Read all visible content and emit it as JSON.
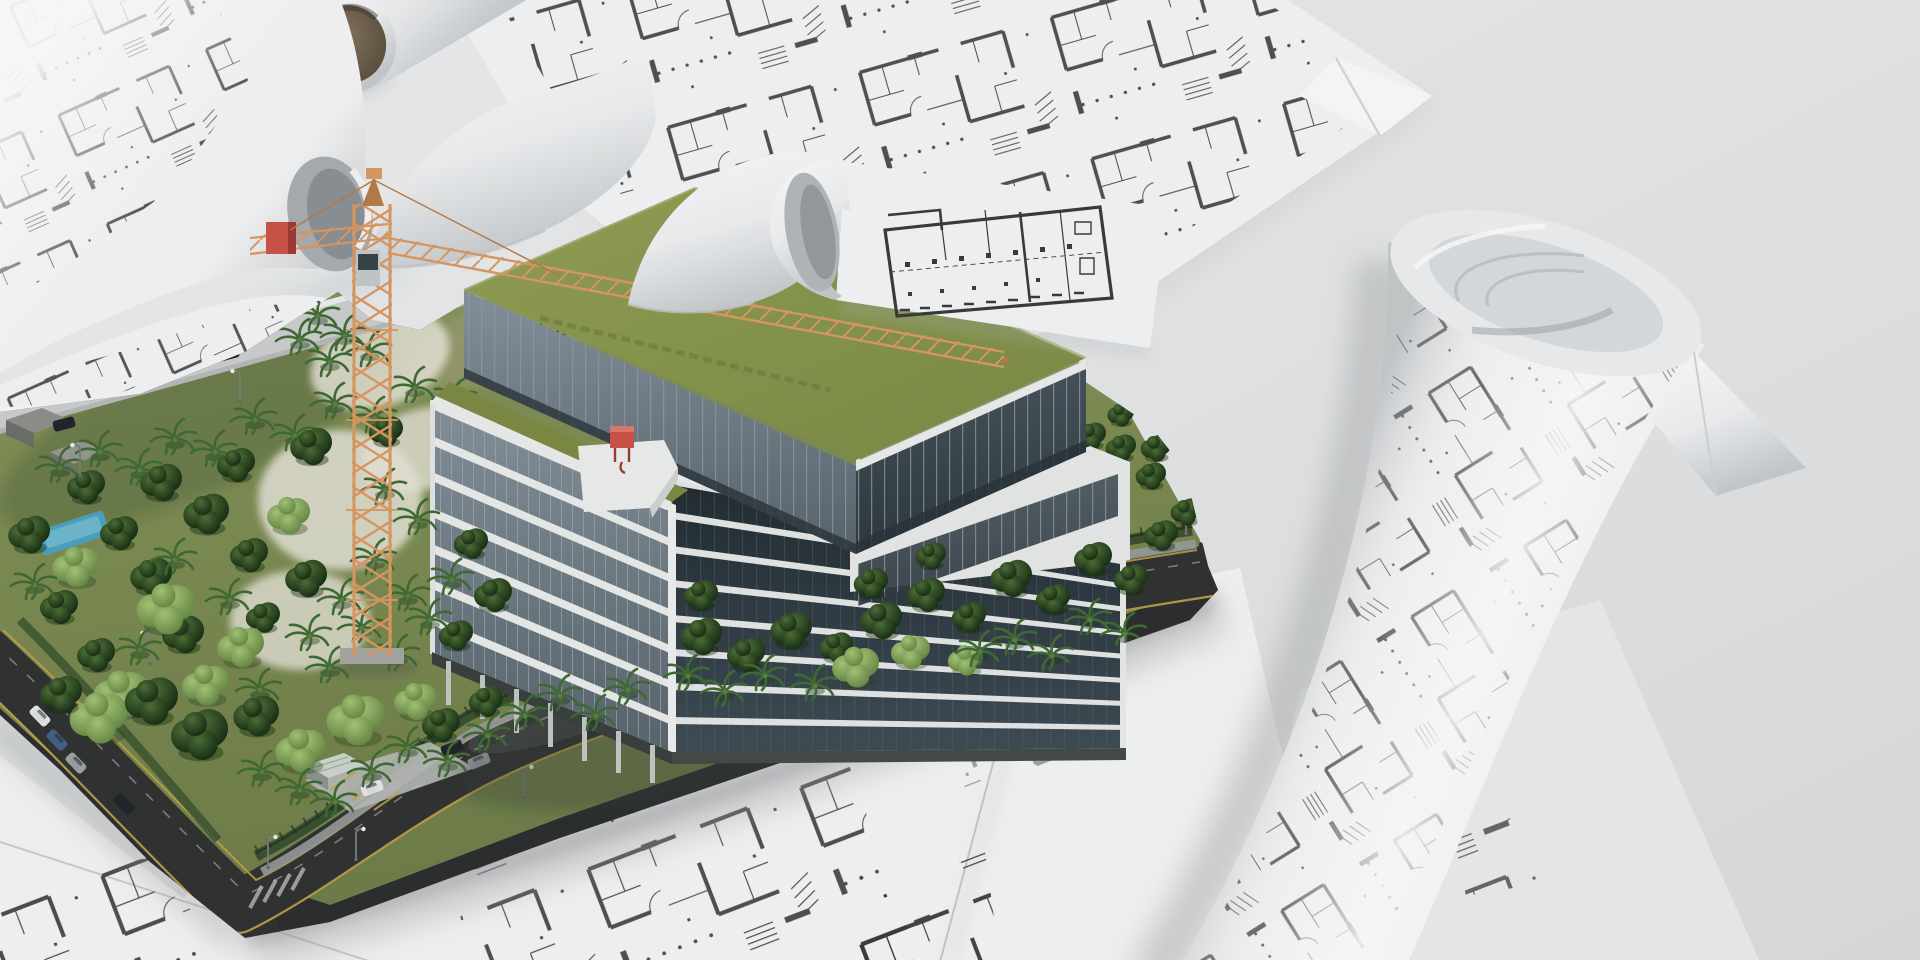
{
  "meta": {
    "type": "3d-architectural-render",
    "width": 1920,
    "height": 960
  },
  "scene": {
    "alt": "3D rendering of an architectural site model: a modern mid-rise building with glass facades and a green grass roof stands among dense tropical trees on a city block bordered by dark asphalt roads with parked cars; an orange tower crane with a red counterweight rises beside the building. The model sits on top of scattered flat and rolled-up blueprint sheets covered with black floor-plan drawings on a light gray surface.",
    "objects": [
      {
        "id": "blueprint-sheet-top",
        "label": "large flat floor-plan sheet, upper right"
      },
      {
        "id": "blueprint-roll-top-left",
        "label": "unrolling blueprint with arched fold, top left"
      },
      {
        "id": "blueprint-tube",
        "label": "paper roll with brown cardboard core"
      },
      {
        "id": "blueprint-curl-center",
        "label": "curled sheet with prominent floor plan, top center"
      },
      {
        "id": "blueprint-roll-right",
        "label": "large blueprint roll lying diagonally, right side"
      },
      {
        "id": "blueprint-sheets-bottom",
        "label": "overlapping floor-plan sheets under the model"
      },
      {
        "id": "site-model",
        "label": "landscaped city-block site model with roads, cars and trees"
      },
      {
        "id": "building",
        "label": "mid-rise building, glass facade, green roof, rooftop box"
      },
      {
        "id": "tower-crane",
        "label": "orange lattice tower crane, red counterweight, gray cab"
      }
    ]
  },
  "palette": {
    "bg1": "#eff1f2",
    "bg2": "#e6e8ea",
    "bg3": "#dcdee0",
    "ink": "#3a3c3e",
    "paper": "#f6f7f8",
    "paper2": "#eceef0",
    "paper3": "#d9dcde",
    "shadow": "#9aa0a4",
    "core1": "#8a7a64",
    "core2": "#584c3a",
    "grass1": "#8b9a5e",
    "grass2": "#70804a",
    "grassdark": "#5a6b3f",
    "dirt": "#9b9070",
    "dry": "#b3a98c",
    "sand": "#e9e6da",
    "road": "#313334",
    "roadlight": "#cfd0d1",
    "yellow": "#c9a54b",
    "sidewalk": "#9b9d9e",
    "hedge": "#3a5330",
    "treeD1": "#4f7038",
    "treeD2": "#1c3517",
    "treeL1": "#a8c878",
    "treeL2": "#5f8340",
    "palm": "#416d34",
    "palmlite": "#5d8046",
    "bwhite": "#eef0ef",
    "bshade": "#d5d9d8",
    "glass1": "#87949d",
    "glass2": "#5a666f",
    "glassd1": "#49545c",
    "glassd2": "#2f3940",
    "void1": "#222c33",
    "void2": "#404d56",
    "roof1": "#93a257",
    "roof2": "#7d8c45",
    "roofshadow": "#6c7a3e",
    "crane": "#dd9b63",
    "craned": "#b97c49",
    "red": "#cd5449",
    "redd": "#a23c33",
    "cab": "#c5cacc",
    "carD": "#22262a",
    "carW": "#e6e8e9",
    "carB": "#46628a",
    "carS": "#9fa4a8",
    "pool": "#4fa3c0"
  },
  "site": {
    "trees": [
      [
        "p",
        60,
        468
      ],
      [
        "p",
        100,
        452
      ],
      [
        "p",
        140,
        470
      ],
      [
        "p",
        175,
        440
      ],
      [
        "p",
        215,
        452
      ],
      [
        "p",
        255,
        420
      ],
      [
        "p",
        295,
        436
      ],
      [
        "p",
        335,
        404
      ],
      [
        "p",
        375,
        418
      ],
      [
        "p",
        415,
        388
      ],
      [
        "p",
        455,
        400
      ],
      [
        "p",
        495,
        370
      ],
      [
        "p",
        532,
        346
      ],
      [
        "p",
        566,
        322
      ],
      [
        "p",
        292,
        300
      ],
      [
        "p",
        318,
        316
      ],
      [
        "p",
        345,
        336
      ],
      [
        "p",
        370,
        352
      ],
      [
        "p",
        300,
        340
      ],
      [
        "p",
        330,
        362
      ],
      [
        "d",
        85,
        492,
        1
      ],
      [
        "d",
        160,
        488,
        1.1
      ],
      [
        "d",
        235,
        470,
        1
      ],
      [
        "d",
        310,
        452,
        1.1
      ],
      [
        "d",
        385,
        436,
        0.9
      ],
      [
        "d",
        460,
        420,
        1
      ],
      [
        "d",
        528,
        382,
        0.9
      ],
      [
        "d",
        552,
        262,
        0.9
      ],
      [
        "d",
        584,
        274,
        0.8
      ],
      [
        "d",
        618,
        252,
        0.8
      ],
      [
        "d",
        28,
        540,
        1.1
      ],
      [
        "d",
        118,
        538,
        1
      ],
      [
        "d",
        205,
        520,
        1.2
      ],
      [
        "d",
        58,
        612,
        1
      ],
      [
        "d",
        150,
        582,
        1.1
      ],
      [
        "d",
        248,
        560,
        1
      ],
      [
        "d",
        305,
        584,
        1.1
      ],
      [
        "d",
        95,
        660,
        1
      ],
      [
        "d",
        182,
        640,
        1.1
      ],
      [
        "d",
        262,
        622,
        0.9
      ],
      [
        "l",
        75,
        572,
        1.2
      ],
      [
        "l",
        165,
        615,
        1.5
      ],
      [
        "l",
        240,
        652,
        1.2
      ],
      [
        "l",
        120,
        700,
        1.4
      ],
      [
        "l",
        205,
        690,
        1.2
      ],
      [
        "l",
        288,
        520,
        1.1
      ],
      [
        "p",
        35,
        585
      ],
      [
        "p",
        140,
        650
      ],
      [
        "p",
        230,
        600
      ],
      [
        "p",
        175,
        560
      ],
      [
        "p",
        310,
        636
      ],
      [
        "p",
        342,
        600
      ],
      [
        "p",
        260,
        690
      ],
      [
        "p",
        330,
        668
      ],
      [
        "p",
        375,
        560
      ],
      [
        "p",
        408,
        596
      ],
      [
        "p",
        362,
        628
      ],
      [
        "p",
        398,
        656
      ],
      [
        "p",
        430,
        620
      ],
      [
        "p",
        452,
        580
      ],
      [
        "p",
        418,
        520
      ],
      [
        "p",
        385,
        490
      ],
      [
        "d",
        470,
        548,
        0.9
      ],
      [
        "d",
        492,
        600,
        1
      ],
      [
        "d",
        455,
        640,
        0.9
      ],
      [
        "l",
        355,
        726,
        1.5
      ],
      [
        "l",
        300,
        756,
        1.3
      ],
      [
        "l",
        415,
        706,
        1.1
      ],
      [
        "l",
        98,
        724,
        1.5
      ],
      [
        "d",
        150,
        708,
        1.4
      ],
      [
        "d",
        198,
        742,
        1.5
      ],
      [
        "d",
        255,
        722,
        1.2
      ],
      [
        "d",
        60,
        700,
        1.1
      ],
      [
        "d",
        440,
        730,
        1
      ],
      [
        "d",
        485,
        706,
        0.9
      ],
      [
        "p",
        300,
        790
      ],
      [
        "p",
        262,
        772
      ],
      [
        "p",
        335,
        802
      ],
      [
        "p",
        372,
        772
      ],
      [
        "p",
        408,
        748
      ],
      [
        "p",
        448,
        762
      ],
      [
        "p",
        488,
        736
      ],
      [
        "p",
        525,
        716
      ],
      [
        "p",
        560,
        696
      ],
      [
        "p",
        596,
        716
      ],
      [
        "p",
        628,
        690
      ],
      [
        "d",
        700,
        642,
        1.1
      ],
      [
        "d",
        745,
        660,
        1
      ],
      [
        "d",
        790,
        636,
        1.1
      ],
      [
        "d",
        835,
        652,
        0.9
      ],
      [
        "d",
        700,
        600,
        0.9
      ],
      [
        "d",
        880,
        626,
        1.1
      ],
      [
        "d",
        925,
        600,
        1
      ],
      [
        "d",
        968,
        622,
        0.9
      ],
      [
        "d",
        1010,
        584,
        1.1
      ],
      [
        "d",
        1052,
        604,
        0.9
      ],
      [
        "d",
        1092,
        564,
        1
      ],
      [
        "d",
        1130,
        584,
        0.9
      ],
      [
        "d",
        1160,
        540,
        0.9
      ],
      [
        "d",
        1185,
        516,
        0.8
      ],
      [
        "d",
        1150,
        480,
        0.8
      ],
      [
        "d",
        1120,
        452,
        0.8
      ],
      [
        "d",
        870,
        588,
        0.9
      ],
      [
        "d",
        930,
        560,
        0.8
      ],
      [
        "l",
        855,
        672,
        1.2
      ],
      [
        "l",
        910,
        656,
        1
      ],
      [
        "l",
        965,
        664,
        0.9
      ],
      [
        "p",
        688,
        676
      ],
      [
        "p",
        725,
        692
      ],
      [
        "p",
        765,
        676
      ],
      [
        "p",
        815,
        686
      ],
      [
        "p",
        980,
        652
      ],
      [
        "p",
        1015,
        640
      ],
      [
        "p",
        1052,
        656
      ],
      [
        "p",
        1090,
        620
      ],
      [
        "p",
        1125,
        634
      ],
      [
        "d",
        1060,
        420,
        0.8
      ],
      [
        "d",
        1090,
        440,
        0.8
      ],
      [
        "d",
        1120,
        418,
        0.7
      ],
      [
        "d",
        1155,
        452,
        0.8
      ]
    ],
    "cars": [
      {
        "x": 228,
        "y": 354,
        "r": -15,
        "c": "carD"
      },
      {
        "x": 64,
        "y": 424,
        "r": -15,
        "c": "carD"
      },
      {
        "x": 40,
        "y": 716,
        "r": 46,
        "c": "carW"
      },
      {
        "x": 57,
        "y": 740,
        "r": 46,
        "c": "carB"
      },
      {
        "x": 76,
        "y": 763,
        "r": 46,
        "c": "carS"
      },
      {
        "x": 124,
        "y": 804,
        "r": 46,
        "c": "carD"
      },
      {
        "x": 452,
        "y": 748,
        "r": -22,
        "c": "carD"
      },
      {
        "x": 479,
        "y": 761,
        "r": -22,
        "c": "carS"
      },
      {
        "x": 372,
        "y": 788,
        "r": -20,
        "c": "carW"
      }
    ],
    "lamps": [
      {
        "x": 420,
        "y": 322
      },
      {
        "x": 240,
        "y": 402
      },
      {
        "x": 80,
        "y": 476
      },
      {
        "x": 150,
        "y": 664
      },
      {
        "x": 208,
        "y": 754
      },
      {
        "x": 268,
        "y": 868,
        "k": 1
      },
      {
        "x": 356,
        "y": 860,
        "k": 1
      },
      {
        "x": 524,
        "y": 798,
        "k": 1
      },
      {
        "x": 704,
        "y": 724,
        "k": 1
      },
      {
        "x": 886,
        "y": 652,
        "k": 1
      },
      {
        "x": 1058,
        "y": 590,
        "k": 1
      },
      {
        "x": 1186,
        "y": 534,
        "k": 1
      }
    ]
  }
}
